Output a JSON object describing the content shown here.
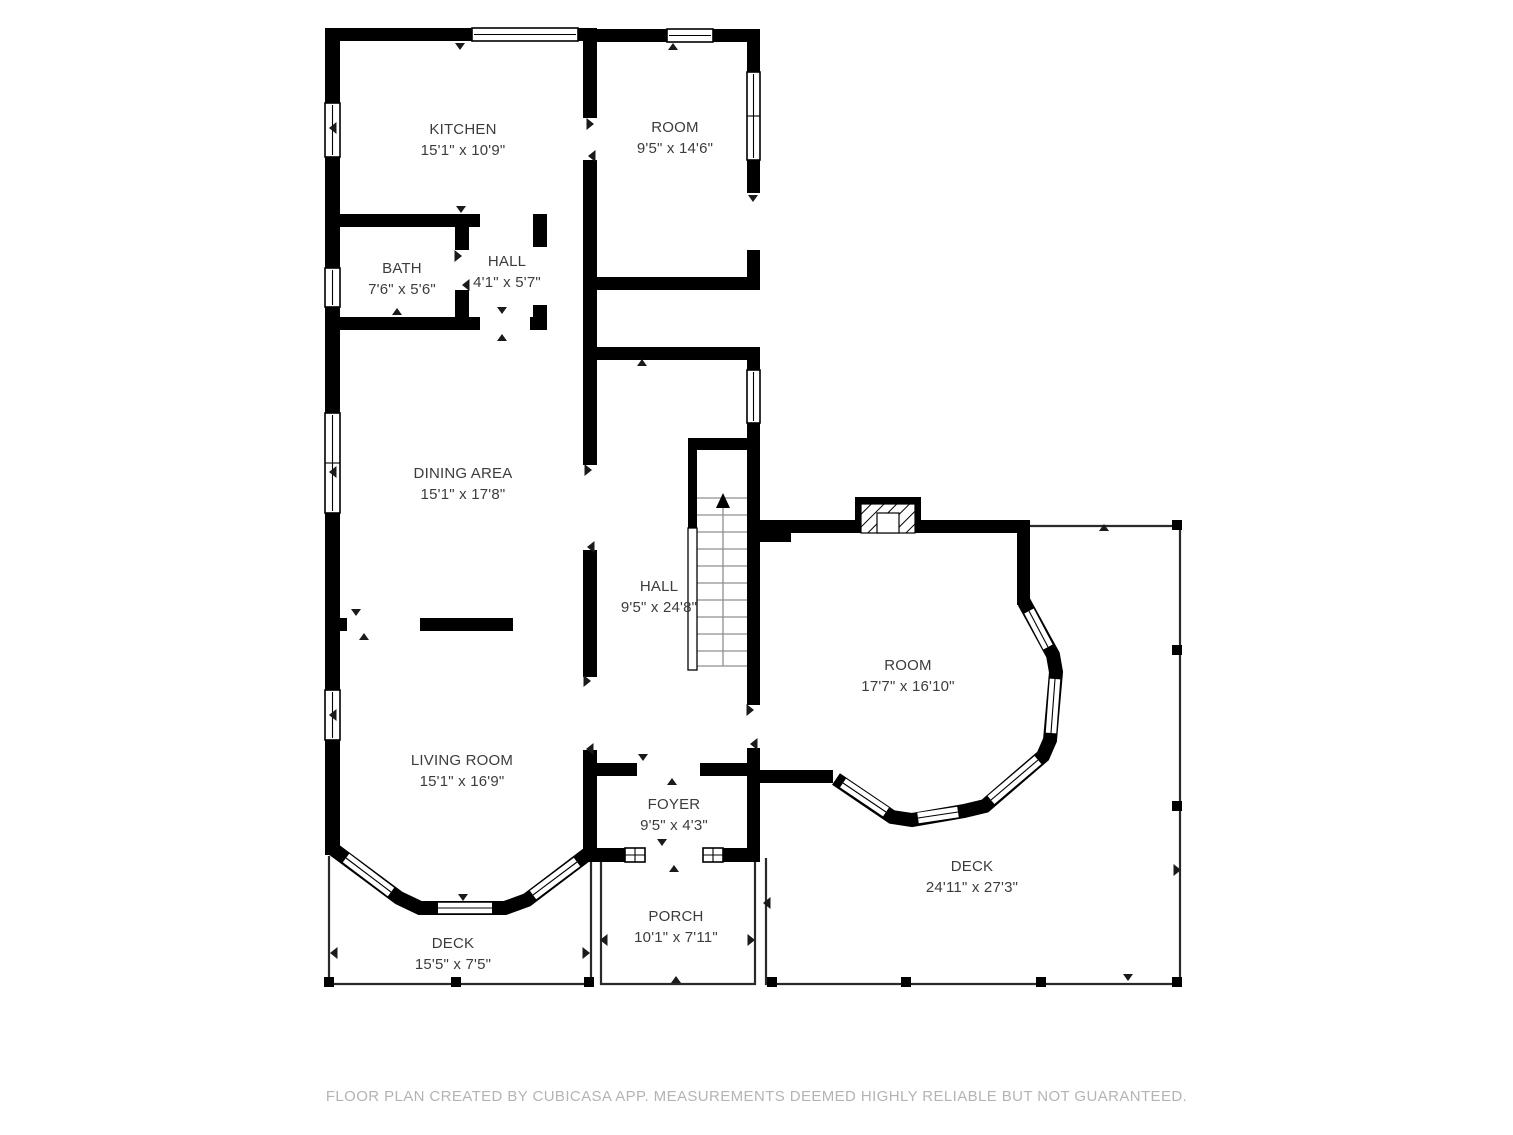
{
  "floor_plan": {
    "rooms": [
      {
        "id": "kitchen",
        "name": "KITCHEN",
        "dims": "15'1\" x 10'9\""
      },
      {
        "id": "room-upper",
        "name": "ROOM",
        "dims": "9'5\" x 14'6\""
      },
      {
        "id": "bath",
        "name": "BATH",
        "dims": "7'6\" x 5'6\""
      },
      {
        "id": "hall-small",
        "name": "HALL",
        "dims": "4'1\" x 5'7\""
      },
      {
        "id": "dining-area",
        "name": "DINING AREA",
        "dims": "15'1\" x 17'8\""
      },
      {
        "id": "hall-main",
        "name": "HALL",
        "dims": "9'5\" x 24'8\""
      },
      {
        "id": "room-right",
        "name": "ROOM",
        "dims": "17'7\" x 16'10\""
      },
      {
        "id": "living-room",
        "name": "LIVING ROOM",
        "dims": "15'1\" x 16'9\""
      },
      {
        "id": "foyer",
        "name": "FOYER",
        "dims": "9'5\" x 4'3\""
      },
      {
        "id": "deck-left",
        "name": "DECK",
        "dims": "15'5\" x 7'5\""
      },
      {
        "id": "porch",
        "name": "PORCH",
        "dims": "10'1\" x 7'11\""
      },
      {
        "id": "deck-right",
        "name": "DECK",
        "dims": "24'11\" x 27'3\""
      }
    ],
    "footer": "FLOOR PLAN CREATED BY CUBICASA APP. MEASUREMENTS DEEMED HIGHLY RELIABLE BUT NOT GUARANTEED.",
    "colors": {
      "wall": "#000000",
      "label_text": "#3c3c3c",
      "footer_text": "#b4b4b4",
      "background": "#ffffff"
    }
  }
}
